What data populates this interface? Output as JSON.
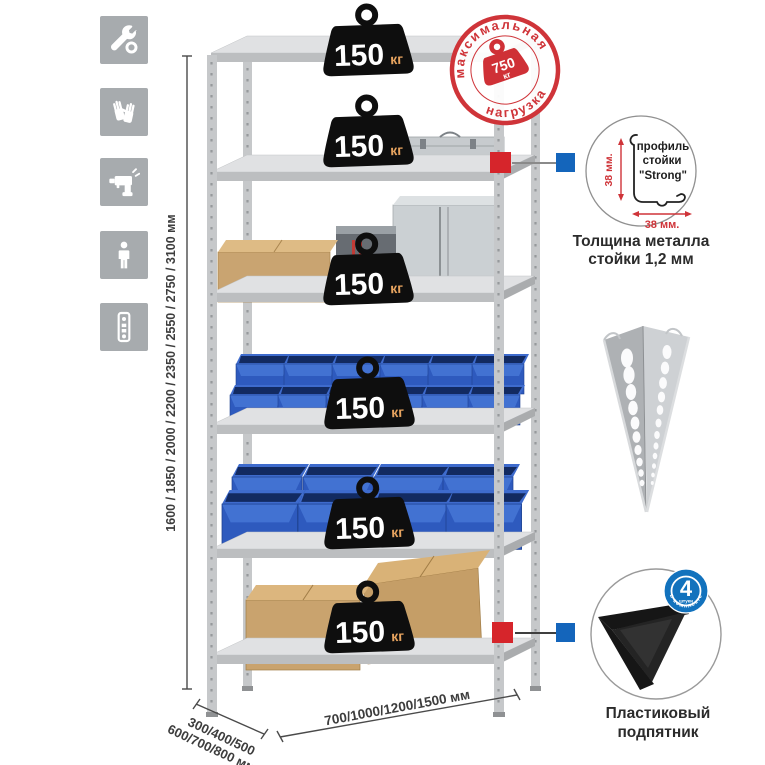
{
  "stamp": {
    "arc_top": "максимальная",
    "arc_bottom": "нагрузка",
    "value": "750",
    "unit": "кг",
    "color": "#cf3439"
  },
  "rack": {
    "shelves": [
      {
        "load": "150",
        "unit": "кг"
      },
      {
        "load": "150",
        "unit": "кг"
      },
      {
        "load": "150",
        "unit": "кг"
      },
      {
        "load": "150",
        "unit": "кг"
      },
      {
        "load": "150",
        "unit": "кг"
      },
      {
        "load": "150",
        "unit": "кг"
      }
    ]
  },
  "dimensions": {
    "height_label": "1600 / 1850 / 2000 / 2200 / 2350 / 2550 / 2750 / 3100 мм",
    "depth_label_line1": "300/400/500",
    "depth_label_line2": "600/700/800 мм",
    "width_label": "700/1000/1200/1500 мм"
  },
  "profile_callout": {
    "label_line1": "профиль",
    "label_line2": "стойки",
    "label_line3": "\"Strong\"",
    "dim_vertical": "38 мм.",
    "dim_horizontal": "38 мм.",
    "caption_line1": "Толщина металла",
    "caption_line2": "стойки 1,2 мм"
  },
  "foot_callout": {
    "badge_value": "4",
    "badge_small": "штуки",
    "badge_arc": "в комплекте",
    "caption_line1": "Пластиковый",
    "caption_line2": "подпятник"
  },
  "sidebar": {
    "icons": [
      {
        "name": "wrench"
      },
      {
        "name": "gloves"
      },
      {
        "name": "drill"
      },
      {
        "name": "person"
      },
      {
        "name": "rack-post"
      }
    ]
  },
  "colors": {
    "stamp_red": "#cf3439",
    "marker_red": "#d6252b",
    "marker_blue": "#1465bb",
    "bin_blue": "#2e5abe",
    "badge_blue": "#1272bd",
    "metal_gray": "#c6c8ca",
    "weight_black": "#0e0e0e",
    "cardboard": "#c9a36e"
  }
}
